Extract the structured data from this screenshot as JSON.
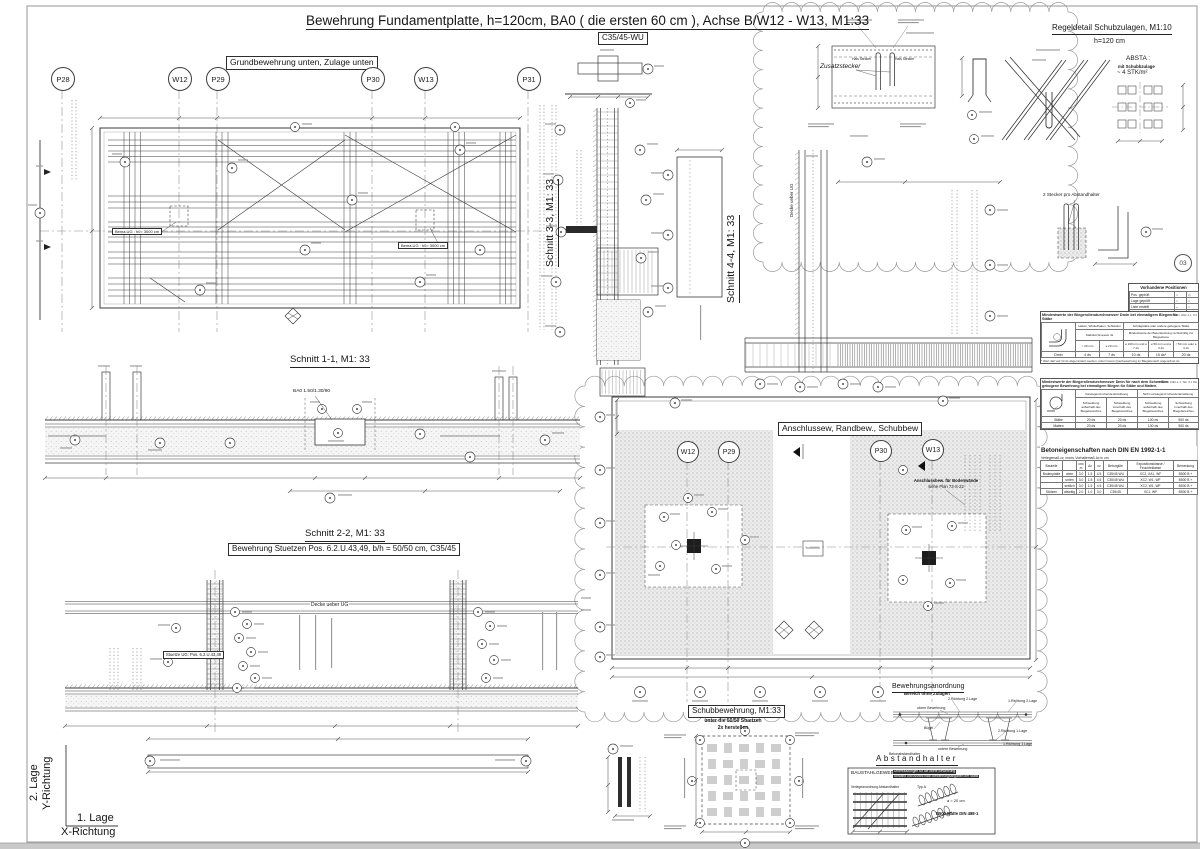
{
  "sheet": {
    "title": "Bewehrung Fundamentplatte, h=120cm,  BA0 ( die ersten 60 cm ), Achse B/W12 - W13, M1:33",
    "concrete_class": "C35/45-WU"
  },
  "plan_unten": {
    "header": "Grundbewehrung unten, Zulage unten",
    "grid_bubbles": [
      "P28",
      "W12",
      "P29",
      "P30",
      "W13",
      "P31"
    ],
    "pit_note": "Bema.UG : h0= 3000 cm"
  },
  "schnitt11": {
    "title": "Schnitt 1-1, M1: 33",
    "ba0_note": "BA0 1.50/1.30/90"
  },
  "schnitt22": {
    "title": "Schnitt 2-2, M1: 33",
    "subtitle": "Bewehrung Stuetzen Pos. 6.2.U.43,49, b/h = 50/50 cm, C35/45",
    "decke_note": "Decke ueber UG",
    "stuetze_note": "Stuetze UG: Pos. 6.2.U.43,49"
  },
  "schnitt33": {
    "title": "Schnitt 3-3, M1: 33"
  },
  "schnitt44": {
    "title": "Schnitt 4-4, M1: 33",
    "decke_note": "Decke ueber UG"
  },
  "anschluss": {
    "header": "Anschlussew, Randbew., Schubbew",
    "grid_bubbles": [
      "W12",
      "P29",
      "P30",
      "W13"
    ],
    "wand_note_1": "Anschlussbew. für Bodenwände",
    "wand_note_2": "siehe Plan 73-S-22"
  },
  "regeldetail": {
    "title": "Regeldetail Schubzulagen, M1:10",
    "subtitle": "h=120 cm",
    "zusatzstecker": "Zusatzstecker",
    "hals_stecker": "Hals Stecker",
    "absta_title": "ABSTA :",
    "absta_line2": "mit Schubbzulage",
    "absta_line3": "~ 4 STK/m²",
    "stecker_note": "2 Stecker pro  Abstandhalter",
    "zone_mark": "03"
  },
  "schub": {
    "title": "Schubbewehrung, M1:33",
    "sub1": "unter die 50/50 Stuetzen",
    "sub2": "2x herstellen"
  },
  "anordnung": {
    "title": "Bewehrungsanordnung",
    "subtitle": "Bereich ohne Zulagen",
    "labels": [
      "2.Richtung 2.Lage",
      "1.Richtung 2.Lage",
      "obere Bewehrung",
      "Bügel",
      "2.Richtung 1.Lage",
      "untere Bewehrung",
      "1.Richtung 1.Lage",
      "Betonabstandhalter"
    ]
  },
  "abstandhalter": {
    "title": "Abstandhalter"
  },
  "baustahl": {
    "title": "BAUSTAHLGEWEBE",
    "note1": "Unterstützungen für die obere Bewehrung",
    "note2": "Abstand und Anzahl nach Bewehrungsangaben der Statik",
    "verlege_note": "Verlegeanordnung Abstandhalter",
    "typ_note": "Typ A",
    "mass_note": "a = 20 cm",
    "din_note": "B500 Matte DIN 488-1"
  },
  "axes": {
    "lage2": "2. Lage",
    "y_dir": "Y-Richtung",
    "lage1": "1. Lage",
    "x_dir": "X-Richtung"
  },
  "tables": {
    "positionen": {
      "title": "Vorhandene Positionen",
      "rows": [
        [
          "Pos. geprüft",
          "○",
          "◇"
        ],
        [
          "Lage geprüft",
          "○",
          "○"
        ],
        [
          "Liste erstellt",
          "–",
          "○"
        ],
        [
          "Bemerkung / Name",
          "△",
          "○"
        ]
      ]
    },
    "dmin1": {
      "title": "Mindestwerte der Biegerollendurchmesser Dmin bei einmaligem Biegen für Stäbe",
      "norm": "DIN EN 1992-1-1, 8.3",
      "head1_left": "Haken, Winkelhaken, Schlaufen",
      "head1_right": "Schrägstäbe oder andere gebogene Stäbe",
      "head2_left": "Stabdurchmesser ds",
      "head2_right": "Mindestwerte der Betondeckung rechtwinklig zur Biegeebene",
      "cols": [
        "< 20 mm",
        "≥ 20 mm",
        "≥ 100 mm und ≥ 7 ds",
        "≥ 50 mm und ≥ 3 ds",
        "< 50 mm oder ≤ 3 ds"
      ],
      "values": [
        "Dmin",
        "4 ds",
        "7 ds",
        "10 ds",
        "15 ds*",
        "20 ds"
      ],
      "footnote": "* Wert darf auf 10 ds abgemindert werden, sofern keine Querbewehrung im Biegebereich angeordnet ist."
    },
    "dmin2": {
      "title": "Mindestwerte der Biegerollendurchmesser Dmin für nach dem Schweißen gebogene Bewehrung bei einmaligem Biegen für Stäbe und Matten.",
      "norm": "DIN EN 1992-1-1, Tab. 8.1 DE",
      "head1_left": "Vorwiegend ruhende Einwirkung",
      "head1_right": "Nicht vorwiegend ruhende Einwirkung",
      "cols": [
        "Schweißung außerhalb des Biegebereiches",
        "Schweißung innerhalb des Biegebereiches",
        "Schweißung außerhalb des Biegebereiches",
        "Schweißung innerhalb des Biegebereiches"
      ],
      "rows": [
        [
          "Stäbe",
          "20 ds",
          "20 ds",
          "100 ds",
          "500 ds"
        ],
        [
          "Matten",
          "20 ds",
          "20 ds",
          "100 ds",
          "500 ds"
        ]
      ]
    },
    "beton": {
      "title": "Betoneigenschaften nach DIN EN 1992-1-1",
      "subnote": "Verlegemaß cv, cnom, Vorhaltemaß Δc in cm",
      "head": [
        "Bauteile",
        "",
        "cnom",
        "Δc",
        "cv",
        "Betongüte",
        "Expositionsklasse / Feuchteklasse",
        "Bemerkung"
      ],
      "rows": [
        [
          "Bodenplatte",
          "oben",
          "3.0",
          "1.5",
          "4.5",
          "C35/45 WU",
          "XC2, XA1, WF",
          "B500 B +"
        ],
        [
          "",
          "unten",
          "3.0",
          "1.5",
          "4.5",
          "C35/45 WU",
          "XC2, W1, WF",
          "B500 B +"
        ],
        [
          "",
          "seitlich",
          "3.0",
          "1.5",
          "4.5",
          "C35/45 WU",
          "XC2, W1, WF",
          "B500 B +"
        ],
        [
          "Stützen",
          "allseitig",
          "2.0",
          "1.0",
          "3.0",
          "C35/45",
          "XC1, WF",
          "B500 B +"
        ]
      ]
    }
  }
}
